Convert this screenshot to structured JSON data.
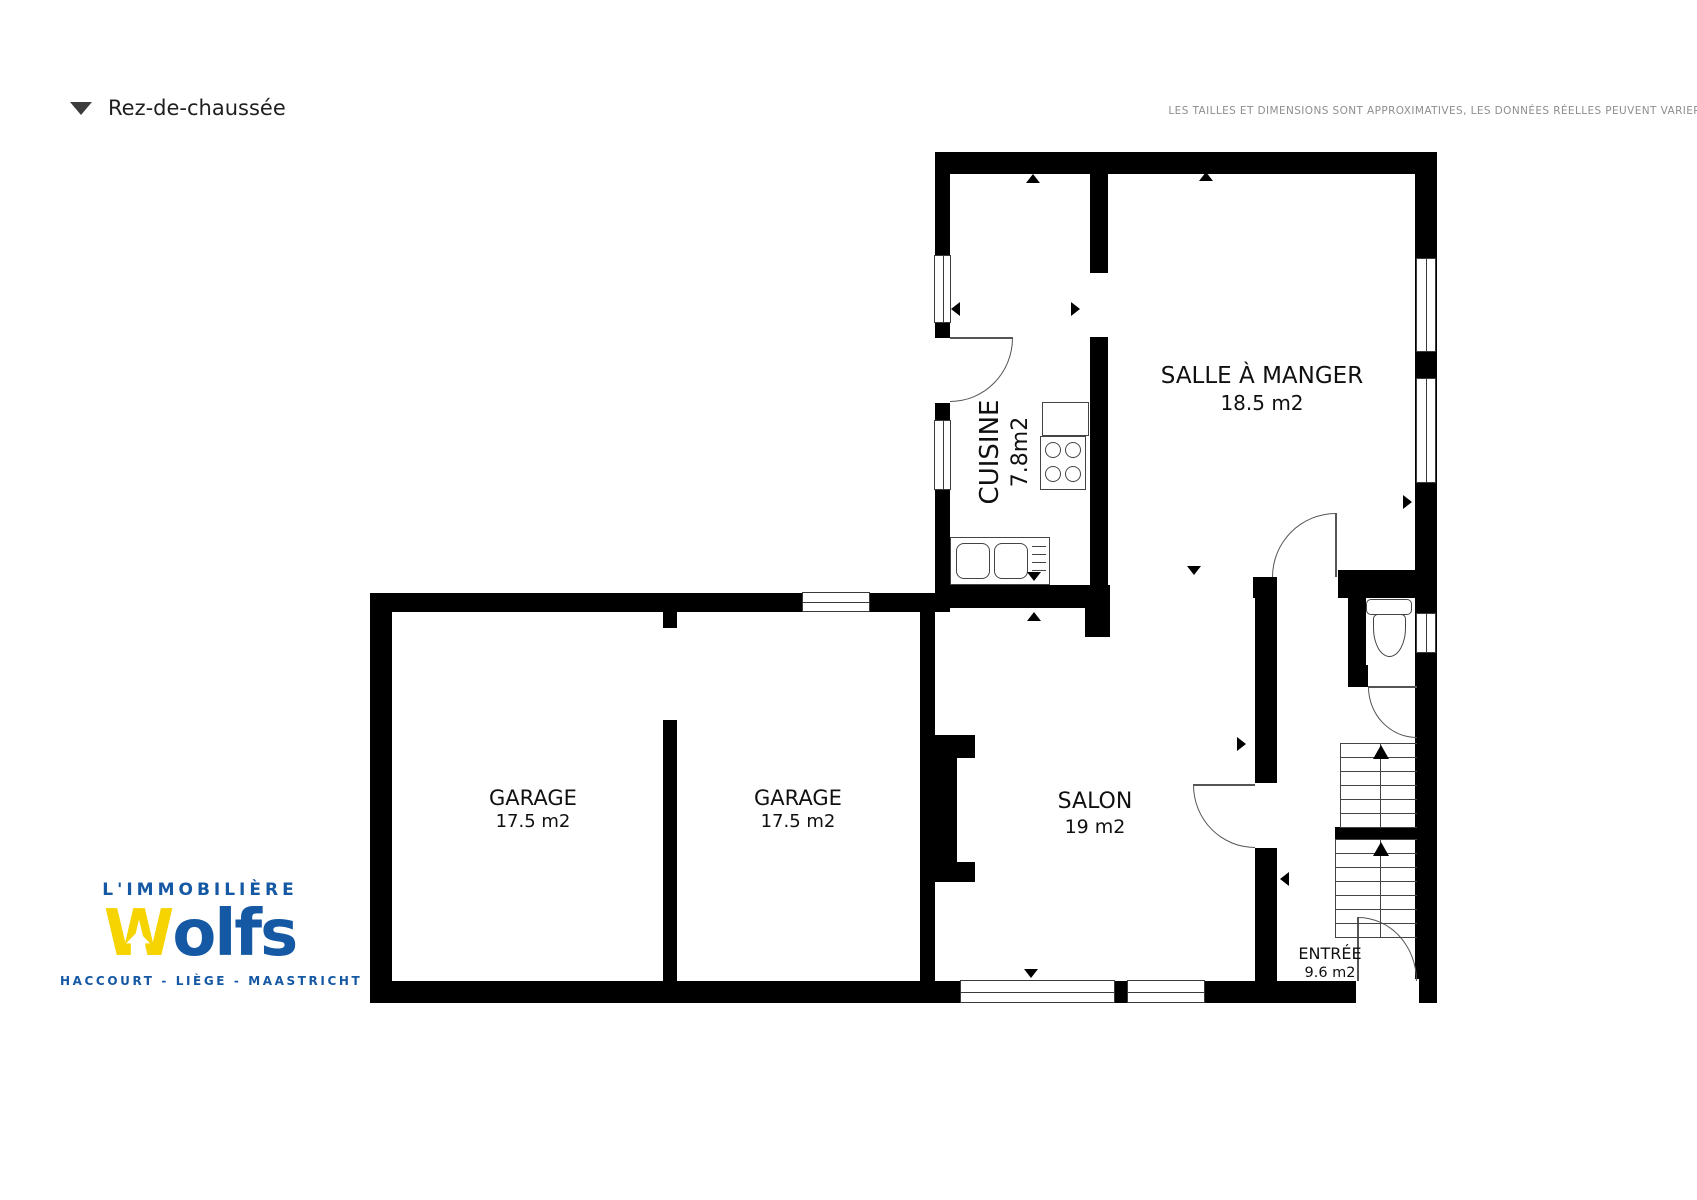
{
  "header": {
    "title": "Rez-de-chaussée",
    "disclaimer": "LES TAILLES ET DIMENSIONS SONT APPROXIMATIVES, LES DONNÉES RÉELLES PEUVENT VARIER"
  },
  "logo": {
    "brand_line": "L'IMMOBILIÈRE",
    "wordmark": {
      "first_letter": "W",
      "rest": "olfs"
    },
    "tagline": "HACCOURT - LIÈGE - MAASTRICHT",
    "colors": {
      "blue": "#1558a4",
      "yellow": "#f6d402"
    }
  },
  "rooms": {
    "cuisine": {
      "name": "CUISINE",
      "area": "7.8m2"
    },
    "salle_a_manger": {
      "name": "SALLE À MANGER",
      "area": "18.5 m2"
    },
    "garage1": {
      "name": "GARAGE",
      "area": "17.5 m2"
    },
    "garage2": {
      "name": "GARAGE",
      "area": "17.5 m2"
    },
    "salon": {
      "name": "SALON",
      "area": "19 m2"
    },
    "entree": {
      "name": "ENTRÉE",
      "area": "9.6 m2"
    }
  }
}
